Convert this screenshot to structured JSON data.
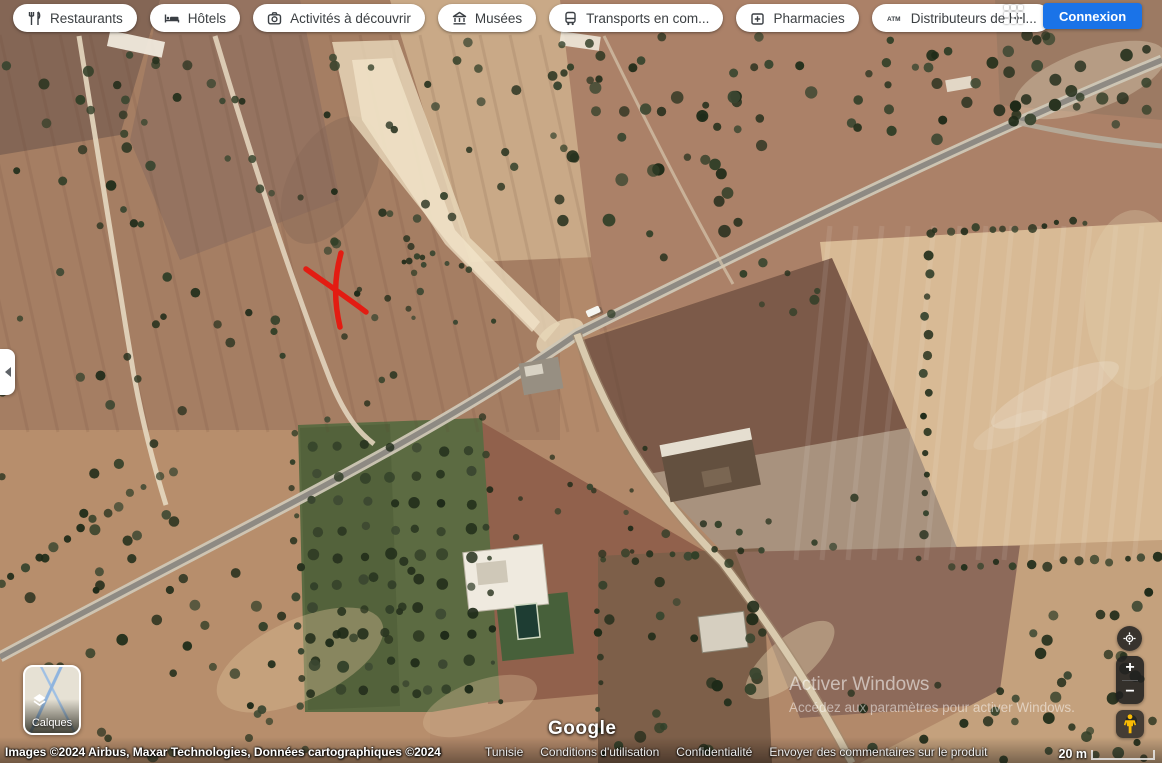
{
  "toolbar": {
    "chips": [
      {
        "label": "Restaurants",
        "icon": "restaurant-icon"
      },
      {
        "label": "Hôtels",
        "icon": "hotel-icon"
      },
      {
        "label": "Activités à découvrir",
        "icon": "camera-icon"
      },
      {
        "label": "Musées",
        "icon": "museum-icon"
      },
      {
        "label": "Transports en com...",
        "icon": "transit-icon"
      },
      {
        "label": "Pharmacies",
        "icon": "pharmacy-icon"
      },
      {
        "label": "Distributeurs de bill...",
        "icon": "atm-icon",
        "icon_text": "ATM"
      }
    ],
    "signin_label": "Connexion"
  },
  "map": {
    "provider_logo": "Google",
    "marker": "red-x-annotation"
  },
  "layers_control": {
    "label": "Calques"
  },
  "zoom_controls": {
    "zoom_in": "+",
    "zoom_out": "−"
  },
  "watermark": {
    "line1": "Activer Windows",
    "line2": "Accédez aux paramètres pour activer Windows."
  },
  "attribution": {
    "imagery": "Images ©2024 Airbus, Maxar Technologies, Données cartographiques ©2024",
    "region": "Tunisie",
    "links": [
      "Conditions d'utilisation",
      "Confidentialité",
      "Envoyer des commentaires sur le produit"
    ],
    "scale": "20 m"
  },
  "colors": {
    "accent": "#1a73e8",
    "marker_red": "#e31c12",
    "pegman": "#fbbc04"
  }
}
